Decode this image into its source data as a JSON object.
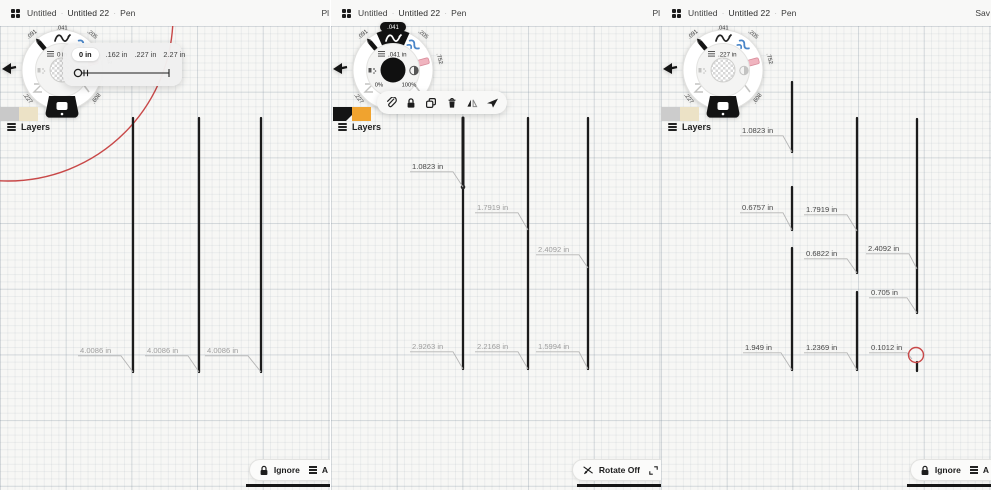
{
  "ui": {
    "sep": "·",
    "layers_label": "Layers"
  },
  "colors": {
    "ink": "#1b1b1b",
    "label_gray": "#9e9e9e",
    "label_dark": "#474747",
    "leader": "#b5b5b5",
    "red": "#c84848",
    "accent_orange": "#f0a32f"
  },
  "wheel_labels": {
    "marker": ".091",
    "pen": ".041",
    "brush": ".205",
    "eraser": ".752",
    "slot_br": ".608",
    "slot_bl": ".227"
  },
  "panels": [
    {
      "topbar": {
        "doc": "Untitled",
        "page": "Untitled 22",
        "tool": "Pen",
        "right": "Pl"
      },
      "swatches": [
        "#c9c9c9",
        "#ece2c6"
      ],
      "swatch_notch": null,
      "wheel": {
        "selected": "bottom",
        "center": "checker",
        "inner_size": "0 in",
        "percents": null
      },
      "size_popup": {
        "options": [
          "0 in",
          ".162 in",
          ".227 in",
          "2.27 in"
        ],
        "selected": 0
      },
      "bottom": {
        "label": "Ignore",
        "extra": "A"
      },
      "strokes": [
        {
          "x": 133,
          "y1": 92,
          "y2": 346
        },
        {
          "x": 199,
          "y1": 92,
          "y2": 346
        },
        {
          "x": 261,
          "y1": 92,
          "y2": 346
        }
      ],
      "callouts": [
        {
          "text": "4.0086 in",
          "tx": 80,
          "ty": 327,
          "ux2": 121,
          "px": 133,
          "py": 346,
          "dark": false
        },
        {
          "text": "4.0086 in",
          "tx": 147,
          "ty": 327,
          "ux2": 188,
          "px": 199,
          "py": 346,
          "dark": false
        },
        {
          "text": "4.0086 in",
          "tx": 207,
          "ty": 327,
          "ux2": 248,
          "px": 261,
          "py": 346,
          "dark": false
        }
      ],
      "dots": [],
      "red_arc": {
        "cx": 8,
        "cy": -10,
        "r": 165
      },
      "red_circle": null
    },
    {
      "topbar": {
        "doc": "Untitled",
        "page": "Untitled 22",
        "tool": "Pen",
        "right": "Pl"
      },
      "swatches": [
        "#141414",
        "#f0a32f"
      ],
      "swatch_notch": 0,
      "wheel": {
        "selected": "top",
        "center": "black",
        "inner_size": ".041 in",
        "percents": [
          "0%",
          "100%"
        ]
      },
      "action_toolbar": {
        "icons": [
          "paperclip",
          "lock",
          "duplicate",
          "trash",
          "flip-horizontal",
          "send"
        ]
      },
      "bottom": {
        "label": "Rotate Off"
      },
      "strokes": [
        {
          "x": 132,
          "y1": 92,
          "y2": 161,
          "w": 3
        },
        {
          "x": 132,
          "y1": 161,
          "y2": 343
        },
        {
          "x": 197,
          "y1": 92,
          "y2": 343
        },
        {
          "x": 257,
          "y1": 92,
          "y2": 343
        }
      ],
      "callouts": [
        {
          "text": "1.0823 in",
          "tx": 81,
          "ty": 143,
          "ux2": 122,
          "px": 132,
          "py": 161,
          "dark": true
        },
        {
          "text": "1.7919 in",
          "tx": 146,
          "ty": 184,
          "ux2": 187,
          "px": 197,
          "py": 204,
          "dark": false
        },
        {
          "text": "2.4092 in",
          "tx": 207,
          "ty": 226,
          "ux2": 248,
          "px": 257,
          "py": 242,
          "dark": false
        },
        {
          "text": "2.9263 in",
          "tx": 81,
          "ty": 323,
          "ux2": 122,
          "px": 132,
          "py": 343,
          "dark": false
        },
        {
          "text": "2.2168 in",
          "tx": 146,
          "ty": 323,
          "ux2": 187,
          "px": 197,
          "py": 343,
          "dark": false
        },
        {
          "text": "1.5994 in",
          "tx": 207,
          "ty": 323,
          "ux2": 248,
          "px": 257,
          "py": 343,
          "dark": false
        }
      ],
      "dots": [
        {
          "x": 132,
          "y": 161
        }
      ],
      "red_arc": null,
      "red_circle": null
    },
    {
      "topbar": {
        "doc": "Untitled",
        "page": "Untitled 22",
        "tool": "Pen",
        "right": "Sav"
      },
      "swatches": [
        "#cccccc",
        "#ece2c6"
      ],
      "swatch_notch": null,
      "wheel": {
        "selected": "bottom",
        "center": "checker",
        "inner_size": ".227 in",
        "percents": null
      },
      "bottom": {
        "label": "Ignore",
        "extra": "A"
      },
      "strokes": [
        {
          "x": 131,
          "y1": 56,
          "y2": 126
        },
        {
          "x": 131,
          "y1": 161,
          "y2": 204
        },
        {
          "x": 131,
          "y1": 222,
          "y2": 344
        },
        {
          "x": 196,
          "y1": 92,
          "y2": 205
        },
        {
          "x": 196,
          "y1": 205,
          "y2": 247
        },
        {
          "x": 196,
          "y1": 266,
          "y2": 344
        },
        {
          "x": 256,
          "y1": 93,
          "y2": 243
        },
        {
          "x": 256,
          "y1": 243,
          "y2": 287
        },
        {
          "x": 256,
          "y1": 336,
          "y2": 345
        }
      ],
      "callouts": [
        {
          "text": "1.0823 in",
          "tx": 81,
          "ty": 107,
          "ux2": 122,
          "px": 131,
          "py": 126,
          "dark": true
        },
        {
          "text": "0.6757 in",
          "tx": 81,
          "ty": 184,
          "ux2": 122,
          "px": 131,
          "py": 204,
          "dark": true
        },
        {
          "text": "1.7919 in",
          "tx": 145,
          "ty": 186,
          "ux2": 186,
          "px": 196,
          "py": 205,
          "dark": true
        },
        {
          "text": "0.6822 in",
          "tx": 145,
          "ty": 230,
          "ux2": 186,
          "px": 196,
          "py": 247,
          "dark": true
        },
        {
          "text": "2.4092 in",
          "tx": 207,
          "ty": 225,
          "ux2": 248,
          "px": 256,
          "py": 243,
          "dark": true
        },
        {
          "text": "0.705 in",
          "tx": 210,
          "ty": 269,
          "ux2": 246,
          "px": 256,
          "py": 287,
          "dark": true
        },
        {
          "text": "1.949 in",
          "tx": 84,
          "ty": 324,
          "ux2": 120,
          "px": 131,
          "py": 344,
          "dark": true
        },
        {
          "text": "1.2369 in",
          "tx": 145,
          "ty": 324,
          "ux2": 186,
          "px": 196,
          "py": 344,
          "dark": true
        },
        {
          "text": "0.1012 in",
          "tx": 210,
          "ty": 324,
          "ux2": 246,
          "px": 251,
          "py": 333,
          "dark": true
        }
      ],
      "dots": [],
      "red_arc": null,
      "red_circle": {
        "cx": 255,
        "cy": 329,
        "r": 7.5
      }
    }
  ]
}
